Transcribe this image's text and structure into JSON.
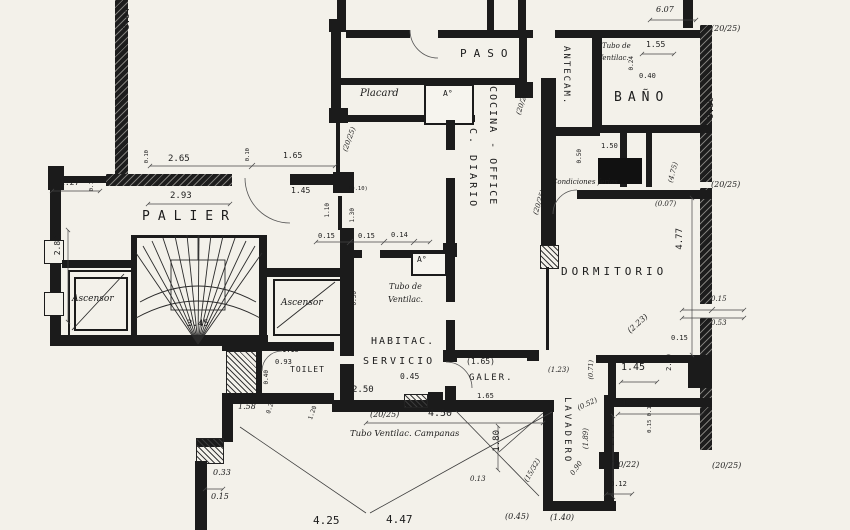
{
  "colors": {
    "paper": "#f3f1ea",
    "ink": "#1b1b1b"
  },
  "rooms": {
    "paso": "PASO",
    "banio": "BAÑO",
    "antecam": "ANTECAM.",
    "cocina_office": "COCINA - OFFICE",
    "c_diario": "C. DIARIO",
    "dormitorio": "DORMITORIO",
    "palier": "PALIER",
    "ascensor_left": "Ascensor",
    "ascensor_right": "Ascensor",
    "placard": "Placard",
    "habitac": "HABITAC.",
    "servicio": "SERVICIO",
    "toilet": "TOILET",
    "galeria": "GALER.",
    "lavadero": "LAVADERO",
    "a_top": "A°",
    "a_serv": "A°"
  },
  "notes": {
    "tubo1a": "Tubo de",
    "tubo1b": "Ventilac.",
    "cond": "Condiciones ferias",
    "tubo2a": "Tubo de",
    "tubo2b": "Ventilac.",
    "campanas": "Tubo Ventilac. Campanas"
  },
  "dims": {
    "d884": "8.84",
    "d607": "6.07",
    "c2025a": "(20/25)",
    "d155": "1.55",
    "d024": "0.24",
    "d040": "0.40",
    "d986": "9.86",
    "c2025b": "(20/25)",
    "d150": "1.50",
    "d050": "0.50",
    "c475": "(4.75)",
    "c2025c": "(20/25)",
    "c2025d": "(20/25)",
    "c007": "(0.07)",
    "d477": "4.77",
    "d015a": "0.15",
    "d053": "0.53",
    "d015b": "0.15",
    "c223": "(2.23)",
    "c2025e": "(20/25)",
    "d265": "2.65",
    "d010a": "0.10",
    "d010b": "0.10",
    "d165": "1.65",
    "c2025f": "(20/25)",
    "d127": "1.27",
    "d010c": "0.10",
    "d293": "2.93",
    "d145": "1.45",
    "c010": "(0.10)",
    "d110": "1.10",
    "d130": "1.30",
    "d280": "2.80",
    "d345": "3.45",
    "d015c": "0.15",
    "d015d": "0.15",
    "d014": "0.14",
    "d030": "0.30",
    "d115": "1.15",
    "d093": "0.93",
    "d040b": "0.40",
    "d158": "1.58",
    "d020": "0.20",
    "d250": "2.50",
    "d045": "0.45",
    "c2025g": "(20/25)",
    "d450": "4.50",
    "d033": "0.33",
    "d015e": "0.15",
    "d013": "0.13",
    "c1532": "(15/32)",
    "d180": "1.80",
    "c165": "(1.65)",
    "d165b": "1.65",
    "c123": "(1.23)",
    "c071": "(0.71)",
    "c052": "(0.52)",
    "c189": "(1.89)",
    "d090": "0.90",
    "c045": "(0.45)",
    "c140": "(1.40)",
    "d425": "4.25",
    "d447": "4.47",
    "d145b": "1.45",
    "d260": "2.60",
    "d173": "1.73",
    "d214": "2.14",
    "c2022": "(20/22)",
    "d012": "0.12",
    "d01515": "0.15 0.15",
    "c120": "1.20"
  }
}
